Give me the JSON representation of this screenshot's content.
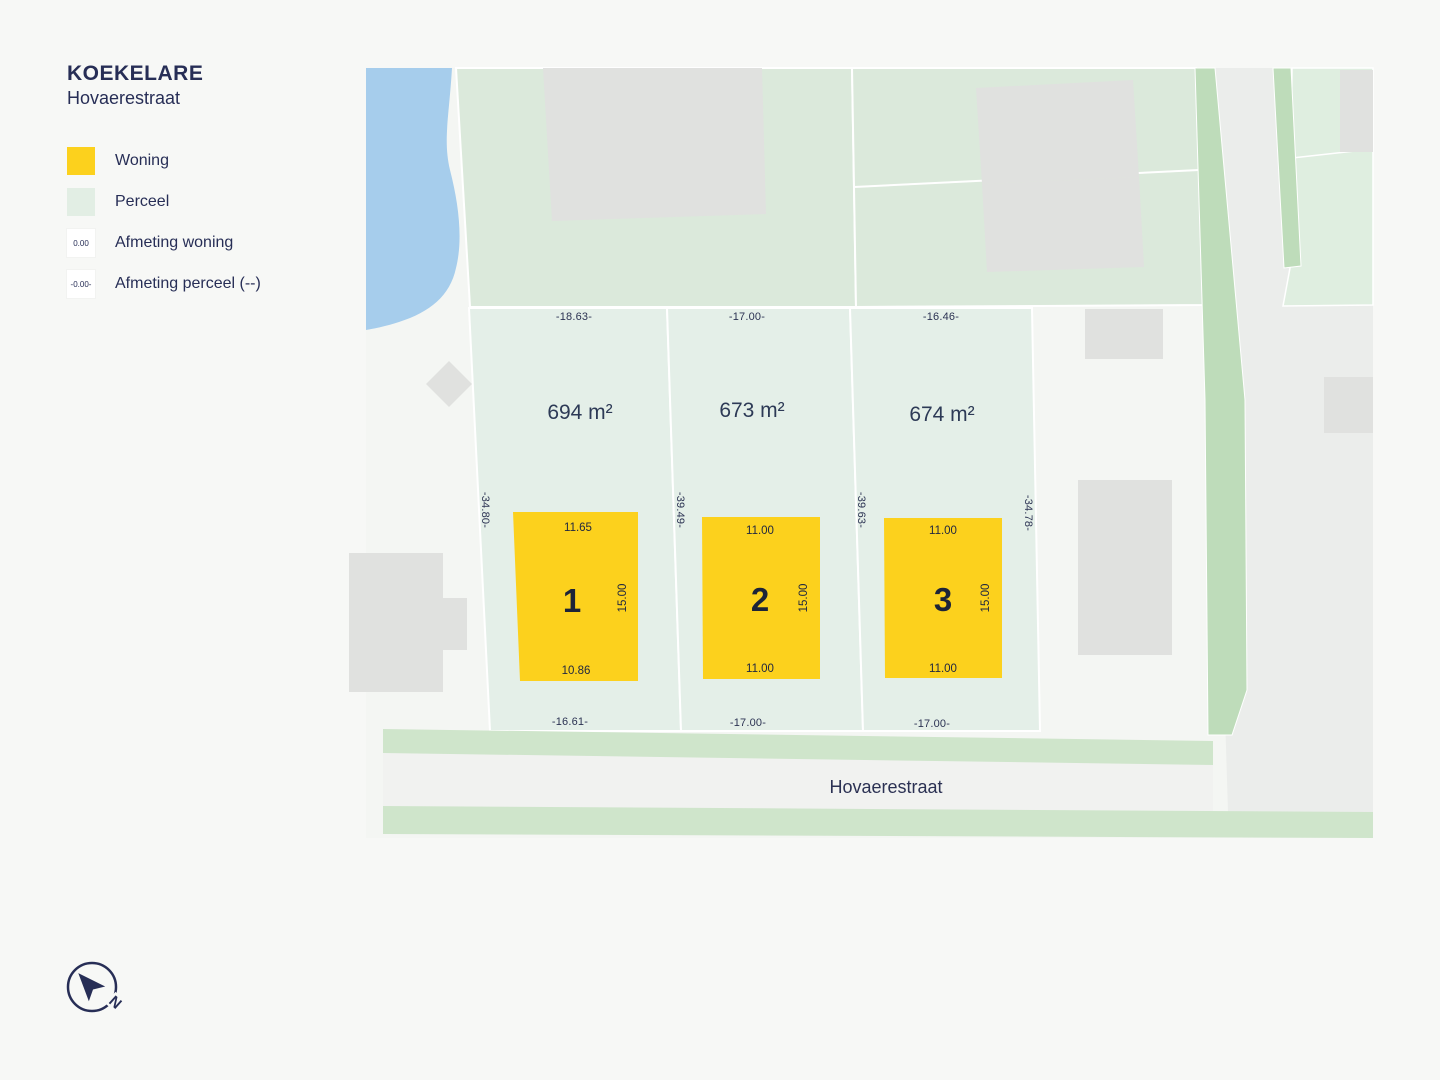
{
  "title": {
    "municipality": "KOEKELARE",
    "street": "Hovaerestraat"
  },
  "legend": {
    "items": [
      {
        "label": "Woning"
      },
      {
        "label": "Perceel"
      },
      {
        "label": "Afmeting woning",
        "swatch_text": "0.00"
      },
      {
        "label": "Afmeting perceel (--)",
        "swatch_text": "-0.00-"
      }
    ]
  },
  "map": {
    "street_label": "Hovaerestraat",
    "compass_label": "N",
    "lots": [
      {
        "number": "1",
        "area_label": "694 m²",
        "dim_top": "-18.63-",
        "dim_bottom": "-16.61-",
        "dim_left": "-34.80-",
        "house": {
          "dim_top": "11.65",
          "dim_bottom": "10.86",
          "dim_side": "15.00"
        }
      },
      {
        "number": "2",
        "area_label": "673 m²",
        "dim_top": "-17.00-",
        "dim_bottom": "-17.00-",
        "dim_left": "-39.49-",
        "house": {
          "dim_top": "11.00",
          "dim_bottom": "11.00",
          "dim_side": "15.00"
        }
      },
      {
        "number": "3",
        "area_label": "674 m²",
        "dim_top": "-16.46-",
        "dim_bottom": "-17.00-",
        "dim_left": "-39.63-",
        "dim_right": "-34.78-",
        "house": {
          "dim_top": "11.00",
          "dim_bottom": "11.00",
          "dim_side": "15.00"
        }
      }
    ]
  },
  "colors": {
    "accent_yellow": "#fcd11d",
    "lot_green": "#e4efe8",
    "parcel_green": "#dbe9db",
    "verge_green": "#cfe5cb",
    "strip_green": "#bedcba",
    "water_blue": "#a6cdec",
    "building_gray": "#e0e1df",
    "navy": "#272e56"
  }
}
